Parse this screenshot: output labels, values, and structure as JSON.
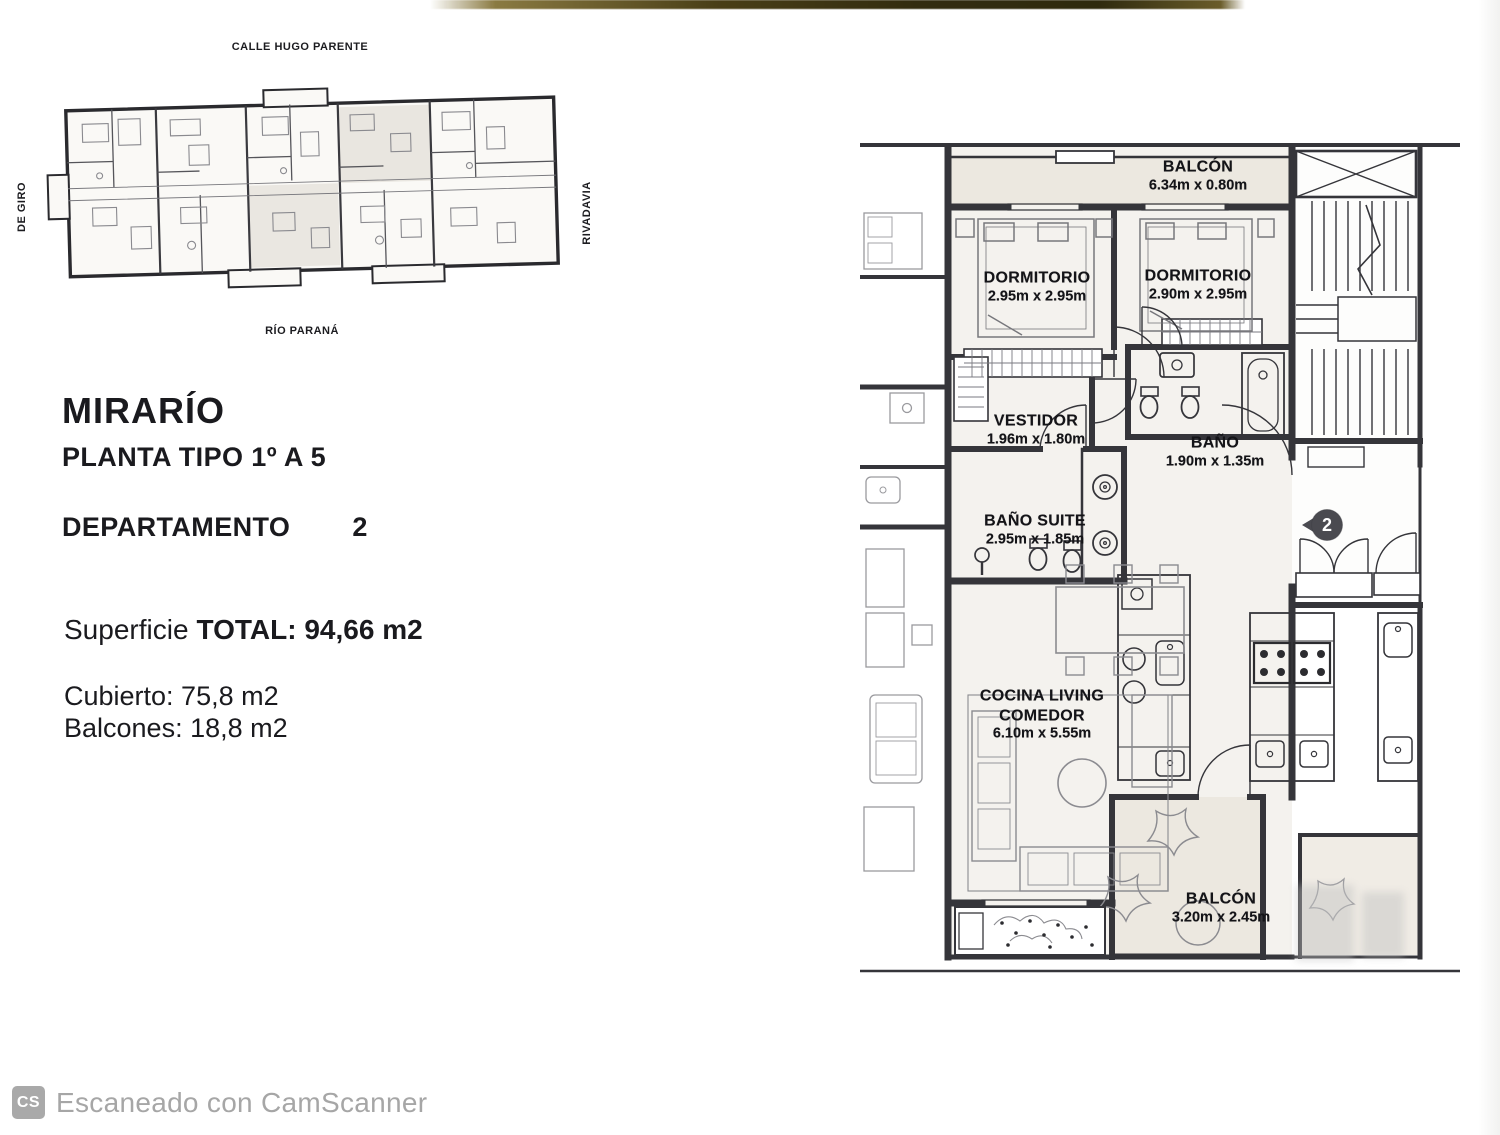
{
  "info": {
    "project": "MIRARÍO",
    "plan_type": "PLANTA TIPO 1º A 5",
    "department_label": "DEPARTAMENTO",
    "department_number": "2",
    "surface_prefix": "Superficie",
    "surface_total": "TOTAL: 94,66 m2",
    "covered": "Cubierto: 75,8 m2",
    "balconies": "Balcones: 18,8 m2"
  },
  "site_plan": {
    "street_top": "CALLE HUGO PARENTE",
    "street_bottom": "RÍO PARANÁ",
    "street_left": "DE GIRO",
    "street_right": "RIVADAVIA"
  },
  "unit_plan": {
    "entry_marker": "2",
    "rooms": [
      {
        "name": "BALCÓN",
        "dims": "6.34m x 0.80m"
      },
      {
        "name": "DORMITORIO",
        "dims": "2.95m x 2.95m"
      },
      {
        "name": "DORMITORIO",
        "dims": "2.90m x 2.95m"
      },
      {
        "name": "VESTIDOR",
        "dims": "1.96m x 1.80m"
      },
      {
        "name": "BAÑO",
        "dims": "1.90m x 1.35m"
      },
      {
        "name": "BAÑO SUITE",
        "dims": "2.95m x 1.85m"
      },
      {
        "name": "COCINA LIVING\nCOMEDOR",
        "dims": "6.10m x 5.55m"
      },
      {
        "name": "BALCÓN",
        "dims": "3.20m x 2.45m"
      }
    ]
  },
  "document": {
    "footer_badge": "CS",
    "footer_text": "Escaneado con CamScanner"
  },
  "colors": {
    "wall": "#35353a",
    "room_fill": "#f4f2ee",
    "balcony_fill": "#ece8e0",
    "marker": "#4a4a50",
    "footer_text": "#a6a6a6",
    "scan_band": "#3a3214"
  }
}
